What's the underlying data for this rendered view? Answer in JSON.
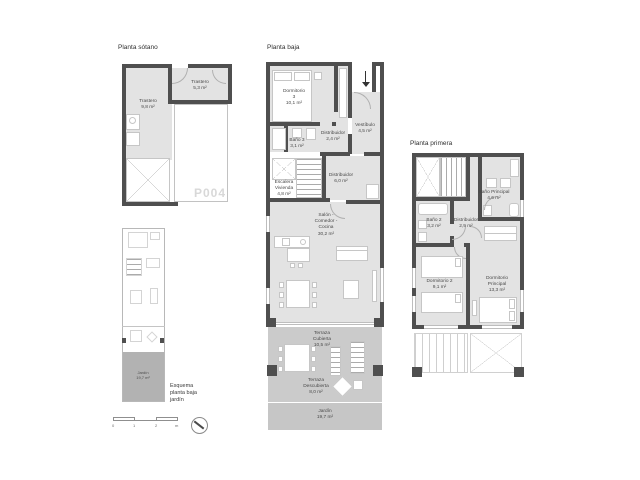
{
  "colors": {
    "wall": "#4f4f4f",
    "room_fill": "#e3e3e3",
    "terrace_fill": "#cbcbcb",
    "garden_fill": "#c6c6c6",
    "esquema_garden_fill": "#b2b2b2",
    "parking_text": "#d8d8d8"
  },
  "plans": {
    "sotano": {
      "title": "Planta sótano",
      "parking_label": "P004",
      "rooms": {
        "trastero1": {
          "name": "Trastero",
          "area": "9,8 m²"
        },
        "trastero2": {
          "name": "Trastero",
          "area": "5,3 m²"
        }
      }
    },
    "baja": {
      "title": "Planta baja",
      "rooms": {
        "dormitorio3": {
          "name": "Dormitorio 3",
          "area": "10,1 m²"
        },
        "vestibulo": {
          "name": "Vestíbulo",
          "area": "4,5 m²"
        },
        "distribuidor1": {
          "name": "Distribuidor",
          "area": "2,4 m²"
        },
        "bano3": {
          "name": "Baño 3",
          "area": "3,1 m²"
        },
        "escalera": {
          "name": "Escalera Vivienda",
          "area": "4,8 m²"
        },
        "distribuidor2": {
          "name": "Distribuidor",
          "area": "6,0 m²"
        },
        "salon": {
          "name": "Salón - Comedor - Cocina",
          "area": "30,2 m²"
        },
        "terraza_cubierta": {
          "name": "Terraza Cubierta",
          "area": "10,5 m²"
        },
        "terraza_descubierta": {
          "name": "Terraza Descubierta",
          "area": "8,0 m²"
        },
        "jardin": {
          "name": "Jardín",
          "area": "19,7 m²"
        }
      }
    },
    "primera": {
      "title": "Planta primera",
      "rooms": {
        "bano_principal": {
          "name": "Baño Principal",
          "area": "4,6 m²"
        },
        "bano2": {
          "name": "Baño 2",
          "area": "3,2 m²"
        },
        "distribuidor": {
          "name": "Distribuidor",
          "area": "2,9 m²"
        },
        "dormitorio2": {
          "name": "Dormitorio 2",
          "area": "9,1 m²"
        },
        "dormitorio_principal": {
          "name": "Dormitorio Principal",
          "area": "13,3 m²"
        }
      }
    },
    "esquema": {
      "caption": "Esquema planta baja jardín",
      "jardin": {
        "name": "Jardín",
        "area": "19,7 m²"
      }
    }
  },
  "scalebar": {
    "ticks": [
      "0",
      "1",
      "2",
      "m"
    ]
  }
}
